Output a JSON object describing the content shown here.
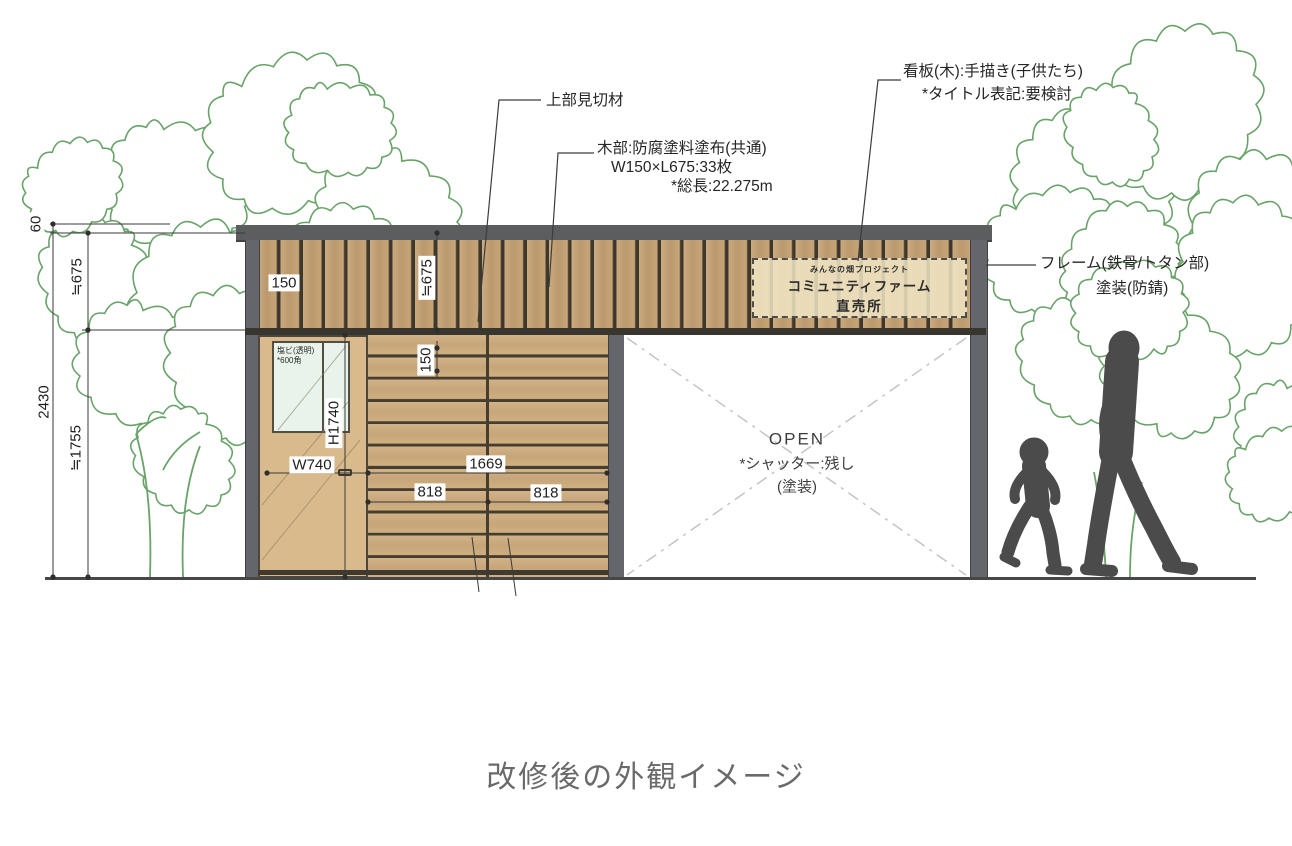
{
  "caption": "改修後の外観イメージ",
  "annotations": {
    "top_trim_label": "上部見切材",
    "wood_note_line1": "木部:防腐塗料塗布(共通)",
    "wood_note_line2": "W150×L675:33枚",
    "wood_note_line3": "*総長:22.275m",
    "signboard_note_line1": "看板(木):手描き(子供たち)",
    "signboard_note_line2": "*タイトル表記:要検討",
    "frame_note_line1": "フレーム(鉄骨/トタン部)",
    "frame_note_line2": "塗装(防錆)",
    "opening_line1": "OPEN",
    "opening_line2": "*シャッター:残し",
    "opening_line3": "(塗装)",
    "door_window_line1": "塩ビ(透明)",
    "door_window_line2": "*600角"
  },
  "signboard": {
    "line1": "みんなの畑プロジェクト",
    "line2": "コミュニティファーム",
    "line3": "直売所"
  },
  "dimensions": {
    "roof_edge": "60",
    "upper_band_height": "≒675",
    "total_height": "2430",
    "lower_wall_height": "≒1755",
    "plank_width": "150",
    "upper_band_height_mid": "≒675",
    "wall_plank_height": "150",
    "door_height": "H1740",
    "door_width": "W740",
    "wall_width": "1669",
    "wall_left_half": "818",
    "wall_right_half": "818"
  },
  "colors": {
    "wood_upper": "#c5a173",
    "wood_lower": "#cfae82",
    "frame_gray": "#5e6063",
    "tree_green": "#69a369",
    "silhouette_gray": "#4b4b4b",
    "sign_bg": "#f0e5c6",
    "window_glass": "#e7f3eb"
  }
}
